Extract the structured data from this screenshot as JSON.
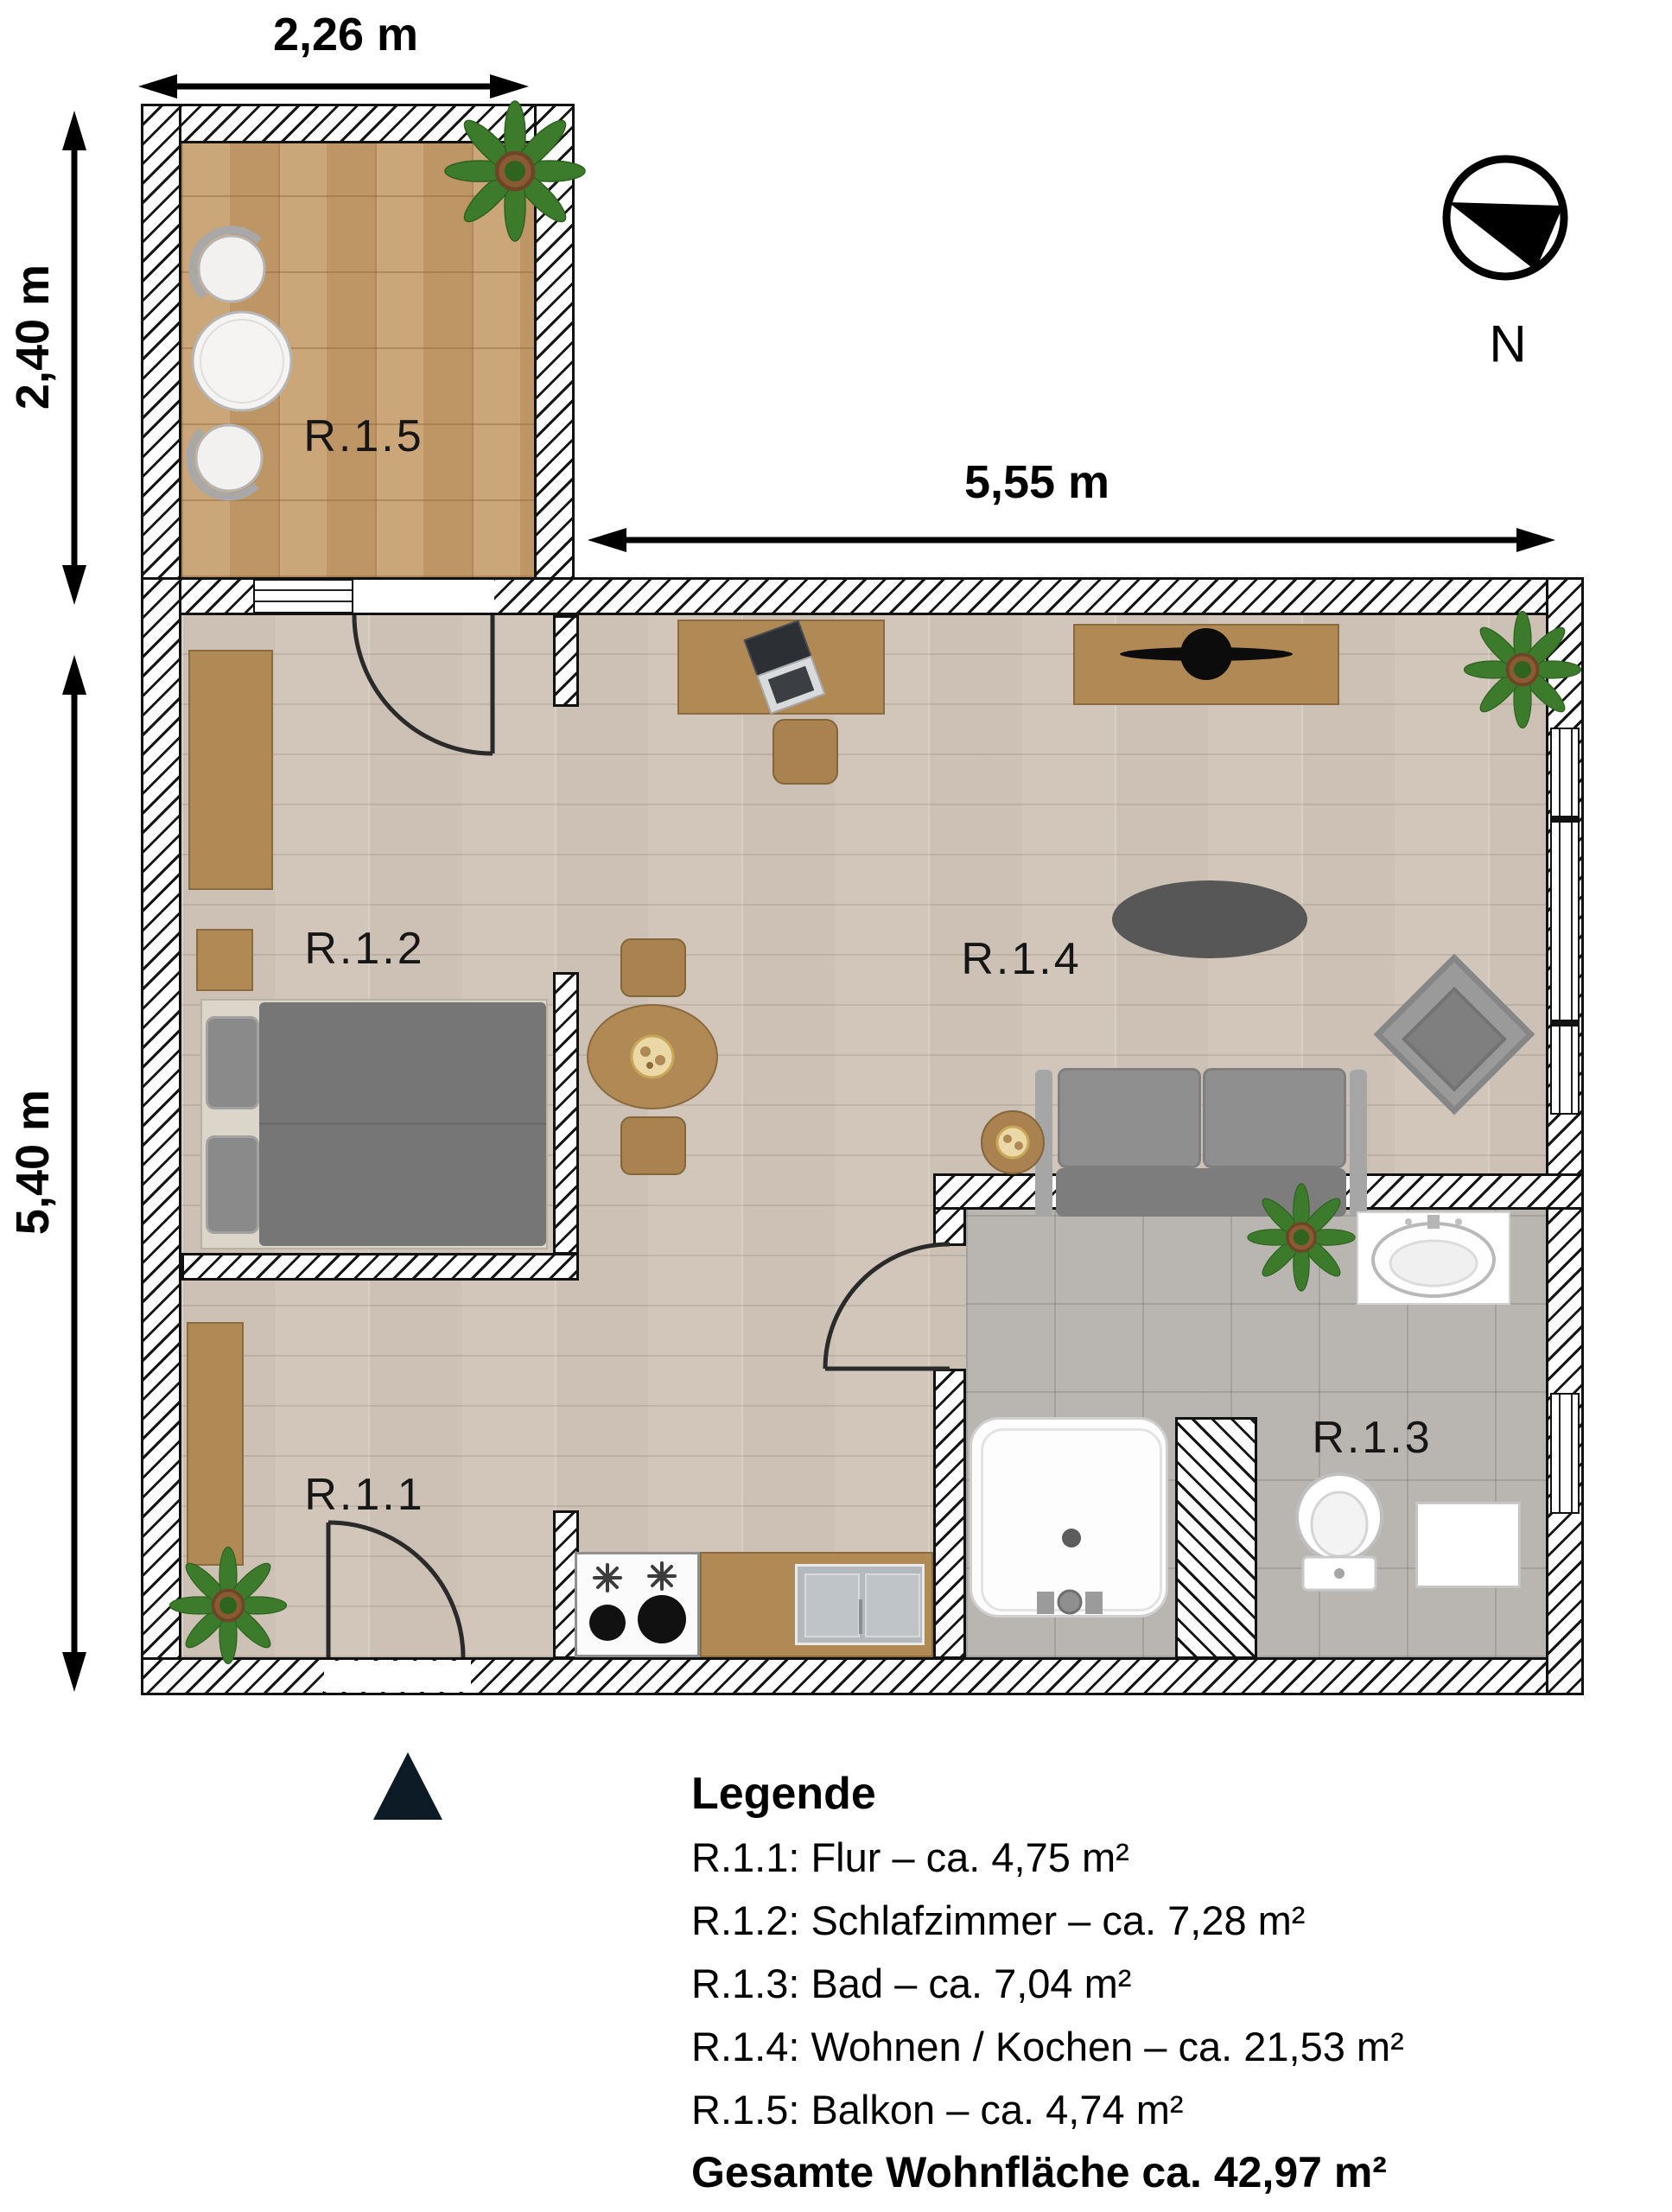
{
  "plan": {
    "type": "apartment-floor-plan",
    "rooms": {
      "r11": {
        "label": "R.1.1",
        "name": "Flur",
        "area": "ca. 4,75 m²"
      },
      "r12": {
        "label": "R.1.2",
        "name": "Schlafzimmer",
        "area": "ca. 7,28 m²"
      },
      "r13": {
        "label": "R.1.3",
        "name": "Bad",
        "area": "ca. 7,04 m²"
      },
      "r14": {
        "label": "R.1.4",
        "name": "Wohnen / Kochen",
        "area": "ca. 21,53 m²"
      },
      "r15": {
        "label": "R.1.5",
        "name": "Balkon",
        "area": "ca. 4,74 m²"
      }
    },
    "dimensions": {
      "balcony_width": "2,26 m",
      "balcony_height": "2,40 m",
      "main_height": "5,40 m",
      "living_width": "5,55 m"
    },
    "compass": {
      "north_label": "N"
    },
    "legend": {
      "title": "Legende",
      "items": [
        "R.1.1: Flur – ca. 4,75 m²",
        "R.1.2: Schlafzimmer – ca. 7,28 m²",
        "R.1.3: Bad – ca. 7,04 m²",
        "R.1.4: Wohnen / Kochen – ca. 21,53 m²",
        "R.1.5: Balkon – ca. 4,74 m²"
      ],
      "total": "Gesamte Wohnfläche ca. 42,97 m²"
    },
    "colors": {
      "wood_floor": "#d4c9be",
      "balcony_tile": "#c79e6c",
      "bath_tile": "#b9b6b1",
      "furniture_brown": "#b08954",
      "sofa_gray": "#8d8d8d",
      "wall_line": "#111111"
    }
  }
}
